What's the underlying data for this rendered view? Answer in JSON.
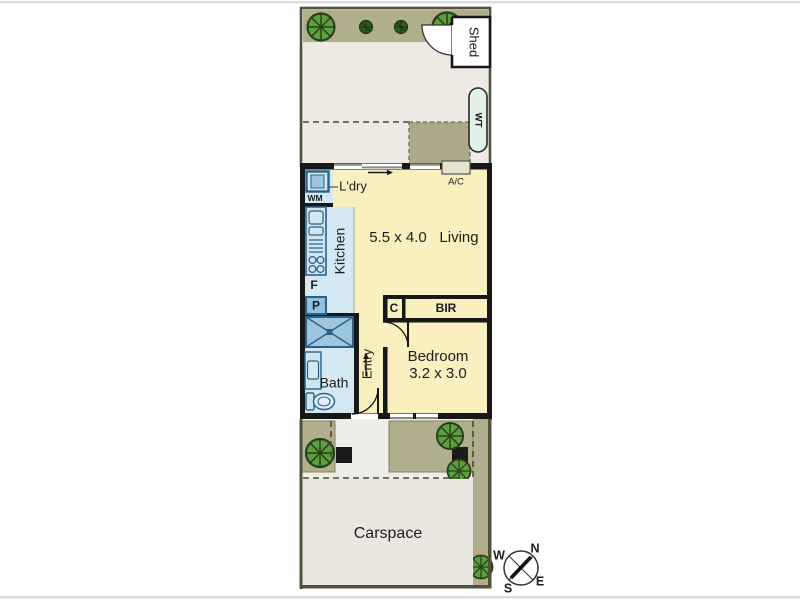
{
  "plan": {
    "rooms": {
      "living": {
        "label": "Living",
        "dims": "5.5 x 4.0"
      },
      "bedroom": {
        "label": "Bedroom",
        "dims": "3.2 x 3.0"
      },
      "kitchen": {
        "label": "Kitchen"
      },
      "bath": {
        "label": "Bath"
      },
      "entry": {
        "label": "Entry"
      },
      "laundry": {
        "label": "L'dry"
      },
      "carspace": {
        "label": "Carspace"
      },
      "shed": {
        "label": "Shed"
      }
    },
    "fixtures": {
      "washing_machine": "WM",
      "fridge": "F",
      "pantry": "P",
      "cupboard": "C",
      "built_in_robe": "BIR",
      "air_conditioner": "A/C",
      "water_tank": "WT"
    },
    "compass": {
      "north": "N",
      "south": "S",
      "east": "E",
      "west": "W"
    },
    "colors": {
      "floor_yellow": "#F9EFBF",
      "wet_area_blue": "#D4E8F2",
      "fixture_blue": "#9CC6E0",
      "fixture_border": "#2B6189",
      "garden_olive": "#B1AE8D",
      "deck_olive": "#ACA98A",
      "yard_gray": "#ECEAE3",
      "carspace_gray": "#E9E7E0",
      "wall_black": "#171717",
      "boundary_olive": "#52523C",
      "tree_green": "#5E9E3D",
      "tree_dark_green": "#2E5A22"
    }
  }
}
